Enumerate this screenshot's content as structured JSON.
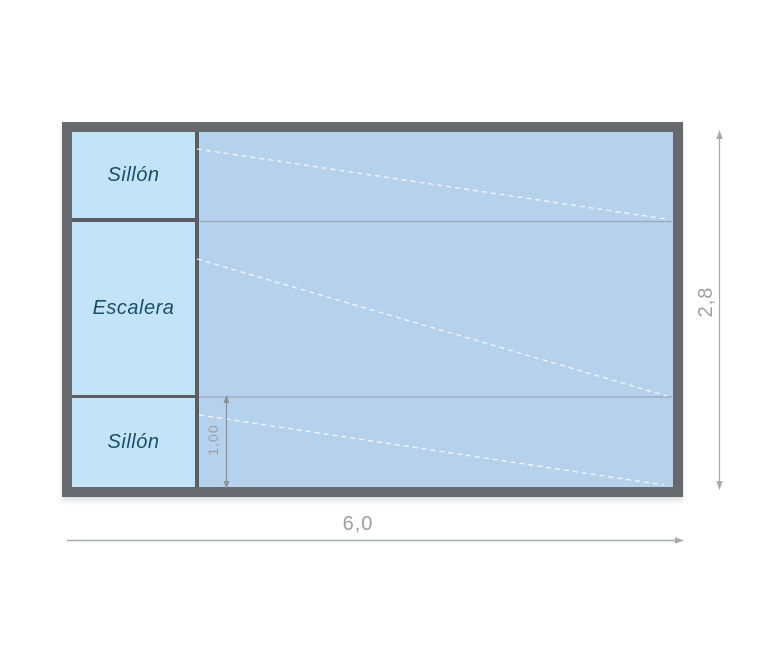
{
  "pool": {
    "features": [
      {
        "label": "Sillón"
      },
      {
        "label": "Escalera"
      },
      {
        "label": "Sillón"
      }
    ],
    "dimensions": {
      "width": "6,0",
      "height": "2,8",
      "feature_width": "1,00"
    },
    "colors": {
      "frame": "#67696e",
      "water": "#b6d1ec",
      "feature_fill": "#c3e4f6",
      "label_text": "#1c4d6b",
      "dimension_text": "#9aa0a6",
      "slope_lines": "#ffffff"
    }
  }
}
